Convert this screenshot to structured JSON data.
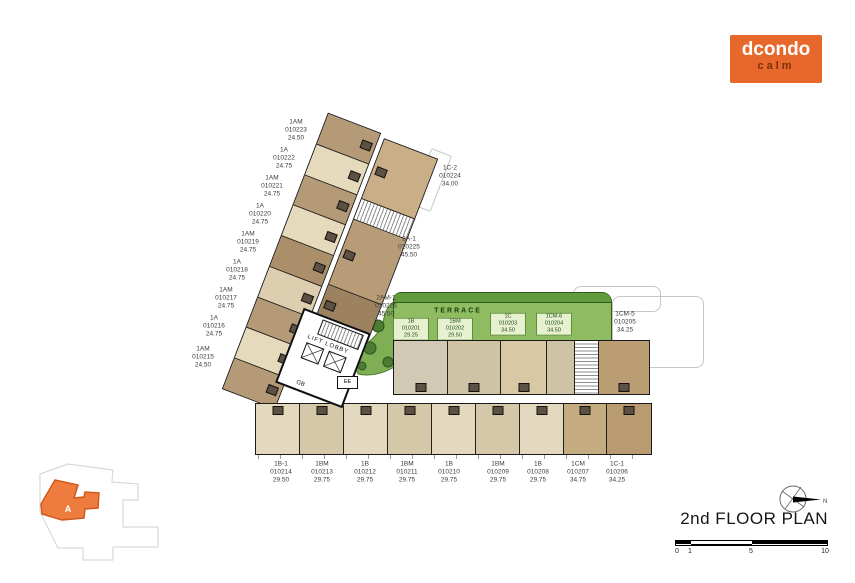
{
  "logo": {
    "brand": "dcondo",
    "sub": "calm"
  },
  "plan": {
    "title": "2nd FLOOR PLAN"
  },
  "scale_bar": {
    "ticks": [
      "0",
      "1",
      "5",
      "10"
    ]
  },
  "compass": {
    "north": "N"
  },
  "site_map": {
    "building": "A"
  },
  "core": {
    "lift_lobby": "LIFT LOBBY",
    "gb": "GB",
    "ee": "EE"
  },
  "terrace": {
    "title": "TERRACE",
    "units": [
      {
        "type": "1B",
        "no": "010201",
        "area": "29.25"
      },
      {
        "type": "1BM",
        "no": "010202",
        "area": "29.50"
      },
      {
        "type": "1C",
        "no": "010203",
        "area": "34.50"
      },
      {
        "type": "1CM-6",
        "no": "010204",
        "area": "34.50"
      }
    ]
  },
  "right_wing_unit": {
    "type": "1CM-5",
    "no": "010205",
    "area": "34.25"
  },
  "wing_left_units": [
    {
      "type": "1AM",
      "no": "010223",
      "area": "24.50"
    },
    {
      "type": "1A",
      "no": "010222",
      "area": "24.75"
    },
    {
      "type": "1AM",
      "no": "010221",
      "area": "24.75"
    },
    {
      "type": "1A",
      "no": "010220",
      "area": "24.75"
    },
    {
      "type": "1AM",
      "no": "010219",
      "area": "24.75"
    },
    {
      "type": "1A",
      "no": "010218",
      "area": "24.75"
    },
    {
      "type": "1AM",
      "no": "010217",
      "area": "24.75"
    },
    {
      "type": "1A",
      "no": "010216",
      "area": "24.75"
    },
    {
      "type": "1AM",
      "no": "010215",
      "area": "24.50"
    }
  ],
  "wing_right_units": [
    {
      "type": "1C-2",
      "no": "010224",
      "area": "34.00"
    },
    {
      "type": "2A-1",
      "no": "010225",
      "area": "45.50"
    },
    {
      "type": "2AM-1",
      "no": "010226",
      "area": "45.50"
    }
  ],
  "bottom_units": [
    {
      "type": "1B-1",
      "no": "010214",
      "area": "29.50"
    },
    {
      "type": "1BM",
      "no": "010213",
      "area": "29.75"
    },
    {
      "type": "1B",
      "no": "010212",
      "area": "29.75"
    },
    {
      "type": "1BM",
      "no": "010211",
      "area": "29.75"
    },
    {
      "type": "1B",
      "no": "010210",
      "area": "29.75"
    },
    {
      "type": "1BM",
      "no": "010209",
      "area": "29.75"
    },
    {
      "type": "1B",
      "no": "010208",
      "area": "29.75"
    },
    {
      "type": "1CM",
      "no": "010207",
      "area": "34.75"
    },
    {
      "type": "1C-1",
      "no": "010206",
      "area": "34.25"
    }
  ],
  "colors": {
    "brand_orange": "#E8682B",
    "logo_sub_brown": "#7A3008",
    "terrace_green": "#8FBC60",
    "terrace_dark_green": "#4E8430",
    "site_building_orange": "#EF7C3F"
  }
}
